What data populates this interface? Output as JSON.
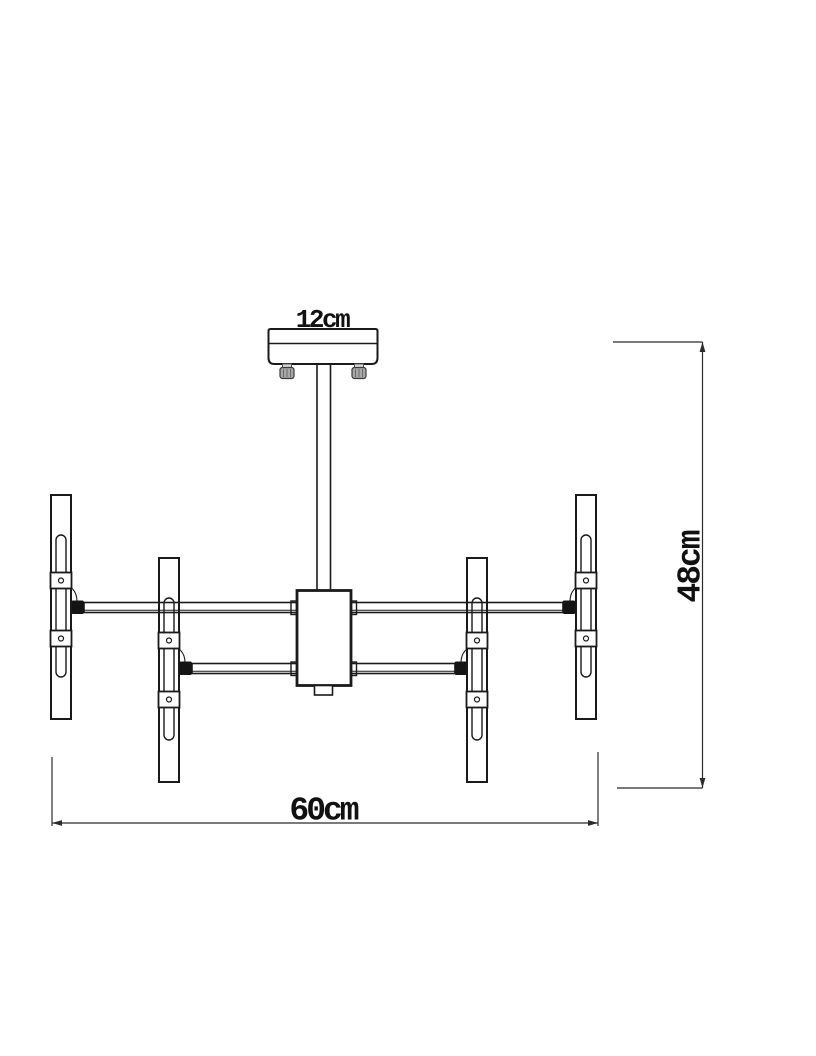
{
  "diagram": {
    "labels": {
      "canopy_width": "12cm",
      "overall_width": "60cm",
      "overall_height": "48cm"
    },
    "colors": {
      "line": "#1a1a1a",
      "dimension": "#2b2b2b",
      "label_text": "#111111",
      "connector": "#141414",
      "screw_body": "#a8a8a8",
      "background": "#ffffff"
    }
  }
}
